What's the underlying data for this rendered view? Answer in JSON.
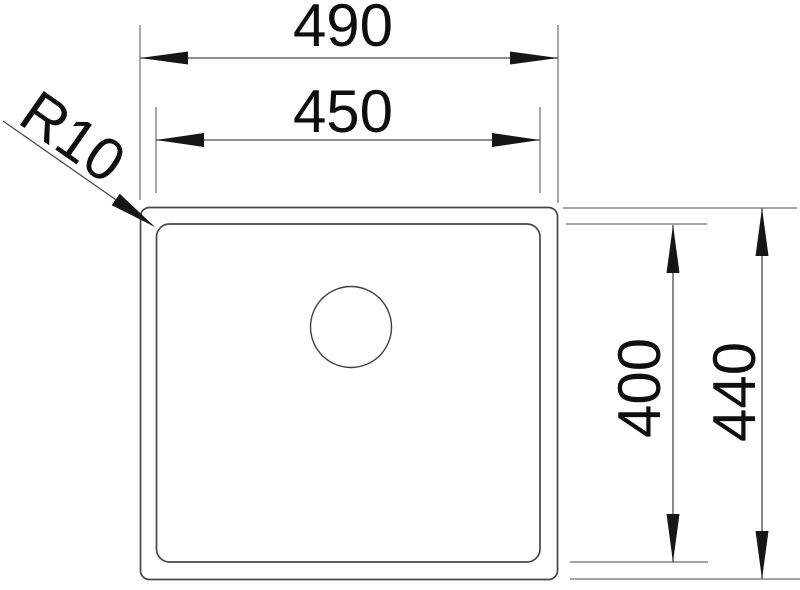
{
  "drawing": {
    "type": "technical-dimension-drawing",
    "background_color": "#ffffff",
    "outline_color": "#474747",
    "dimension_line_color": "#6e6e6e",
    "text_color": "#0f0f0f",
    "dimensions": {
      "outer_width": "490",
      "inner_width": "450",
      "inner_height": "400",
      "outer_height": "440",
      "corner_radius": "R10"
    }
  }
}
